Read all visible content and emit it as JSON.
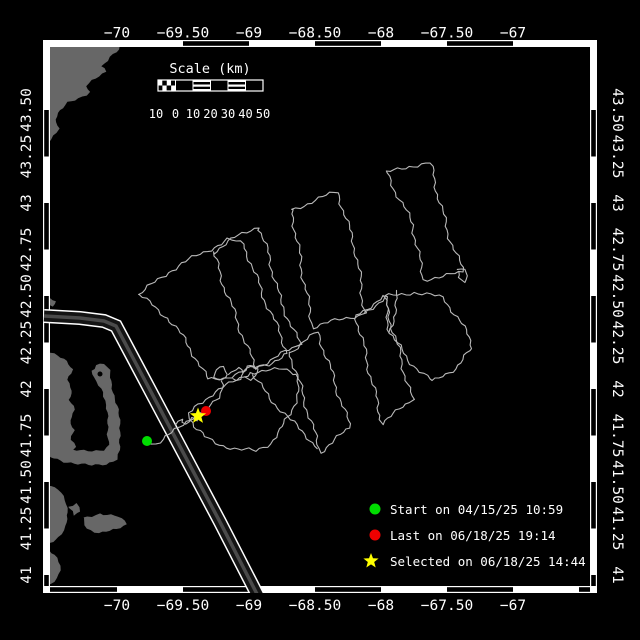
{
  "figure": {
    "background": "#000000",
    "frame_color": "#ffffff",
    "land_color": "#676767",
    "track_color": "#b9b9b9",
    "lane_edge_color": "#ffffff",
    "lane_fill_color": "#141414",
    "lane_center_color": "#4a4a4a"
  },
  "axes": {
    "lon": {
      "labels": [
        "−70",
        "−69.50",
        "−69",
        "−68.50",
        "−68",
        "−67.50",
        "−67"
      ],
      "x": [
        117,
        183,
        249,
        315,
        381,
        447,
        513
      ]
    },
    "lat": {
      "labels": [
        "43.50",
        "43.25",
        "43",
        "42.75",
        "42.50",
        "42.25",
        "42",
        "41.75",
        "41.50",
        "41.25",
        "41"
      ],
      "y": [
        110,
        156.5,
        203,
        249.5,
        296,
        342.5,
        389,
        435.5,
        482,
        528.5,
        575
      ]
    }
  },
  "scalebar": {
    "title": "Scale (km)",
    "numbers": [
      "10",
      "0",
      "10",
      "20",
      "30",
      "40",
      "50"
    ],
    "number_x": [
      156,
      175.5,
      193,
      210.5,
      228,
      245.5,
      263
    ],
    "bar": {
      "x": 158,
      "y": 80,
      "width": 105,
      "height": 11,
      "segment_width": 17.5,
      "striped_segments": [
        193,
        228
      ],
      "checker_end": 175.5
    }
  },
  "legend": {
    "items": [
      {
        "marker": "dot",
        "color": "#00dd00",
        "label": "Start on 04/15/25 10:59"
      },
      {
        "marker": "dot",
        "color": "#ee0000",
        "label": "Last on 06/18/25 19:14"
      },
      {
        "marker": "star",
        "color": "#ffff00",
        "label": "Selected on 06/18/25 14:44"
      }
    ]
  },
  "markers": {
    "start": {
      "x": 147,
      "y": 441,
      "color": "#00dd00"
    },
    "last": {
      "x": 206,
      "y": 411,
      "color": "#ee0000"
    },
    "selected": {
      "x": 198,
      "y": 416,
      "color": "#ffff00"
    }
  },
  "map_geometry": {
    "plot": {
      "left": 50,
      "top": 47,
      "right": 590,
      "bottom": 586,
      "band": 7
    },
    "border_black": {
      "top": [
        [
          183,
          249
        ],
        [
          315,
          381
        ],
        [
          447,
          513
        ]
      ],
      "bottom": [
        [
          50,
          117
        ],
        [
          183,
          249
        ],
        [
          315,
          381
        ],
        [
          447,
          513
        ],
        [
          579,
          590
        ]
      ],
      "left": [
        [
          110,
          156.5
        ],
        [
          203,
          249.5
        ],
        [
          296,
          342.5
        ],
        [
          389,
          435.5
        ],
        [
          482,
          528.5
        ],
        [
          575,
          586
        ]
      ],
      "right": [
        [
          110,
          156.5
        ],
        [
          203,
          249.5
        ],
        [
          296,
          342.5
        ],
        [
          389,
          435.5
        ],
        [
          482,
          528.5
        ],
        [
          575,
          586
        ]
      ]
    },
    "lane": [
      [
        44,
        316
      ],
      [
        80,
        318
      ],
      [
        104,
        321
      ],
      [
        116,
        326
      ],
      [
        150,
        390
      ],
      [
        185,
        456
      ],
      [
        220,
        522
      ],
      [
        258,
        596
      ]
    ],
    "land": [
      {
        "pts": [
          [
            47,
            40
          ],
          [
            124,
            40
          ],
          [
            120,
            50
          ],
          [
            110,
            57
          ],
          [
            101,
            66
          ],
          [
            106,
            72
          ],
          [
            96,
            79
          ],
          [
            86,
            86
          ],
          [
            90,
            92
          ],
          [
            78,
            98
          ],
          [
            68,
            103
          ],
          [
            61,
            111
          ],
          [
            55,
            119
          ],
          [
            58,
            129
          ],
          [
            51,
            139
          ],
          [
            47,
            147
          ]
        ]
      },
      {
        "pts": [
          [
            47,
            350
          ],
          [
            58,
            355
          ],
          [
            66,
            362
          ],
          [
            72,
            370
          ],
          [
            68,
            380
          ],
          [
            73,
            390
          ],
          [
            69,
            400
          ],
          [
            74,
            410
          ],
          [
            70,
            420
          ],
          [
            75,
            430
          ],
          [
            71,
            440
          ],
          [
            76,
            447
          ],
          [
            70,
            451
          ],
          [
            80,
            450
          ],
          [
            92,
            450
          ],
          [
            104,
            450
          ],
          [
            110,
            446
          ],
          [
            108,
            434
          ],
          [
            107,
            420
          ],
          [
            106,
            405
          ],
          [
            104,
            392
          ],
          [
            99,
            385
          ],
          [
            93,
            378
          ],
          [
            91,
            371
          ],
          [
            96,
            365
          ],
          [
            104,
            364
          ],
          [
            109,
            371
          ],
          [
            111,
            381
          ],
          [
            114,
            392
          ],
          [
            117,
            406
          ],
          [
            119,
            420
          ],
          [
            121,
            436
          ],
          [
            120,
            450
          ],
          [
            116,
            459
          ],
          [
            106,
            464
          ],
          [
            92,
            466
          ],
          [
            78,
            464
          ],
          [
            64,
            461
          ],
          [
            54,
            458
          ],
          [
            47,
            456
          ]
        ]
      },
      {
        "pts": [
          [
            83,
            518
          ],
          [
            100,
            513
          ],
          [
            118,
            517
          ],
          [
            127,
            524
          ],
          [
            117,
            530
          ],
          [
            99,
            533
          ],
          [
            87,
            528
          ]
        ]
      },
      {
        "pts": [
          [
            69,
            508
          ],
          [
            77,
            504
          ],
          [
            81,
            511
          ],
          [
            74,
            516
          ]
        ]
      },
      {
        "pts": [
          [
            47,
            485
          ],
          [
            58,
            490
          ],
          [
            65,
            500
          ],
          [
            69,
            512
          ],
          [
            66,
            526
          ],
          [
            58,
            537
          ],
          [
            50,
            543
          ],
          [
            47,
            543
          ]
        ]
      },
      {
        "pts": [
          [
            47,
            548
          ],
          [
            55,
            554
          ],
          [
            60,
            566
          ],
          [
            57,
            578
          ],
          [
            51,
            585
          ],
          [
            47,
            585
          ]
        ]
      },
      {
        "pts": [
          [
            50,
            298
          ],
          [
            56,
            301
          ],
          [
            54,
            307
          ],
          [
            49,
            306
          ]
        ]
      }
    ],
    "land_hole": {
      "x": 100,
      "y": 374,
      "r": 2.5
    },
    "track": [
      {
        "pts": [
          [
            147,
            441
          ],
          [
            156,
            444
          ],
          [
            164,
            440
          ],
          [
            172,
            433
          ],
          [
            179,
            427
          ],
          [
            186,
            421
          ],
          [
            192,
            417
          ],
          [
            198,
            414
          ],
          [
            206,
            411
          ]
        ]
      },
      {
        "pts": [
          [
            176,
            425
          ],
          [
            181,
            418
          ],
          [
            186,
            424
          ],
          [
            191,
            417
          ],
          [
            196,
            422
          ],
          [
            199,
            417
          ]
        ]
      },
      {
        "pts": [
          [
            206,
            411
          ],
          [
            212,
            405
          ],
          [
            218,
            397
          ],
          [
            221,
            389
          ],
          [
            221,
            381
          ]
        ]
      },
      {
        "pts": [
          [
            221,
            381
          ],
          [
            215,
            376
          ],
          [
            217,
            370
          ],
          [
            224,
            368
          ],
          [
            228,
            374
          ],
          [
            224,
            380
          ]
        ]
      },
      {
        "pts": [
          [
            228,
            374
          ],
          [
            233,
            369
          ],
          [
            239,
            368
          ],
          [
            243,
            373
          ],
          [
            239,
            378
          ],
          [
            233,
            378
          ]
        ]
      },
      {
        "pts": [
          [
            243,
            373
          ],
          [
            247,
            366
          ],
          [
            253,
            364
          ],
          [
            258,
            369
          ],
          [
            256,
            376
          ],
          [
            250,
            378
          ],
          [
            245,
            376
          ]
        ]
      },
      {
        "closed": true,
        "pts": [
          [
            250,
            372
          ],
          [
            230,
            384
          ],
          [
            212,
            394
          ],
          [
            198,
            404
          ],
          [
            190,
            414
          ],
          [
            194,
            427
          ],
          [
            204,
            437
          ],
          [
            220,
            444
          ],
          [
            238,
            450
          ],
          [
            256,
            451
          ],
          [
            270,
            443
          ],
          [
            281,
            430
          ],
          [
            290,
            414
          ],
          [
            296,
            398
          ],
          [
            300,
            384
          ],
          [
            297,
            374
          ],
          [
            283,
            370
          ],
          [
            266,
            370
          ]
        ]
      },
      {
        "closed": true,
        "pts": [
          [
            139,
            295
          ],
          [
            168,
            272
          ],
          [
            200,
            254
          ],
          [
            228,
            240
          ],
          [
            244,
            244
          ],
          [
            254,
            272
          ],
          [
            265,
            300
          ],
          [
            277,
            327
          ],
          [
            288,
            353
          ],
          [
            268,
            364
          ],
          [
            247,
            370
          ],
          [
            227,
            377
          ],
          [
            208,
            380
          ],
          [
            196,
            358
          ],
          [
            182,
            336
          ],
          [
            168,
            318
          ],
          [
            152,
            305
          ]
        ]
      },
      {
        "closed": true,
        "pts": [
          [
            213,
            252
          ],
          [
            235,
            238
          ],
          [
            258,
            226
          ],
          [
            269,
            256
          ],
          [
            280,
            300
          ],
          [
            290,
            322
          ],
          [
            300,
            345
          ],
          [
            278,
            356
          ],
          [
            255,
            368
          ],
          [
            244,
            339
          ],
          [
            233,
            310
          ],
          [
            222,
            280
          ]
        ]
      },
      {
        "closed": true,
        "pts": [
          [
            292,
            210
          ],
          [
            315,
            200
          ],
          [
            338,
            192
          ],
          [
            347,
            222
          ],
          [
            356,
            252
          ],
          [
            365,
            313
          ],
          [
            339,
            320
          ],
          [
            313,
            327
          ],
          [
            307,
            297
          ],
          [
            299,
            253
          ]
        ]
      },
      {
        "closed": true,
        "pts": [
          [
            387,
            173
          ],
          [
            409,
            166
          ],
          [
            430,
            163
          ],
          [
            447,
            230
          ],
          [
            463,
            272
          ],
          [
            443,
            277
          ],
          [
            423,
            279
          ],
          [
            413,
            225
          ],
          [
            398,
            196
          ]
        ]
      },
      {
        "pts": [
          [
            458,
            268
          ],
          [
            464,
            271
          ],
          [
            467,
            276
          ],
          [
            463,
            281
          ],
          [
            458,
            278
          ],
          [
            459,
            272
          ]
        ]
      },
      {
        "closed": true,
        "pts": [
          [
            290,
            352
          ],
          [
            304,
            342
          ],
          [
            318,
            332
          ],
          [
            334,
            380
          ],
          [
            350,
            428
          ],
          [
            335,
            440
          ],
          [
            320,
            452
          ],
          [
            305,
            402
          ]
        ]
      },
      {
        "closed": true,
        "pts": [
          [
            356,
            315
          ],
          [
            370,
            306
          ],
          [
            384,
            297
          ],
          [
            398,
            348
          ],
          [
            412,
            400
          ],
          [
            397,
            412
          ],
          [
            382,
            423
          ],
          [
            369,
            369
          ]
        ]
      },
      {
        "closed": true,
        "pts": [
          [
            385,
            297
          ],
          [
            414,
            292
          ],
          [
            443,
            298
          ],
          [
            460,
            320
          ],
          [
            473,
            348
          ],
          [
            455,
            368
          ],
          [
            433,
            382
          ],
          [
            408,
            360
          ],
          [
            390,
            333
          ]
        ]
      },
      {
        "pts": [
          [
            252,
            375
          ],
          [
            270,
            398
          ],
          [
            290,
            420
          ],
          [
            308,
            437
          ],
          [
            318,
            448
          ]
        ]
      },
      {
        "pts": [
          [
            399,
            291
          ],
          [
            394,
            313
          ],
          [
            390,
            333
          ]
        ]
      },
      {
        "pts": [
          [
            365,
            313
          ],
          [
            375,
            305
          ],
          [
            385,
            297
          ]
        ]
      }
    ]
  }
}
